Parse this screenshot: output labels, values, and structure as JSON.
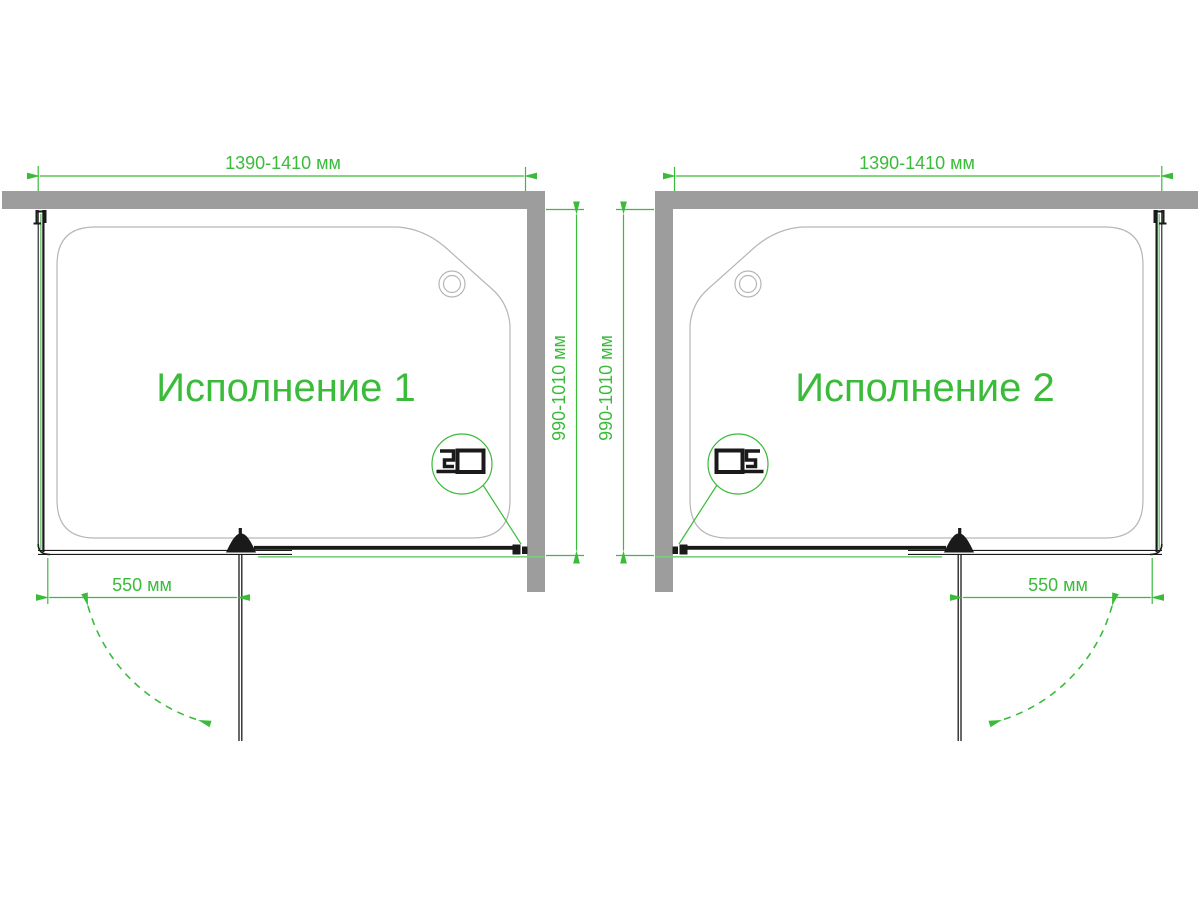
{
  "colors": {
    "accent_green": "#3abb3a",
    "glass_green": "#7fce7f",
    "wall_gray": "#9d9d9d",
    "tray_gray": "#b6b6b6",
    "line_black": "#1a1a1a"
  },
  "diagrams": [
    {
      "label": "Исполнение 1",
      "width_dim": "1390-1410 мм",
      "depth_dim": "990-1010 мм",
      "door_dim": "550 мм"
    },
    {
      "label": "Исполнение 2",
      "width_dim": "1390-1410 мм",
      "depth_dim": "990-1010 мм",
      "door_dim": "550 мм"
    }
  ]
}
